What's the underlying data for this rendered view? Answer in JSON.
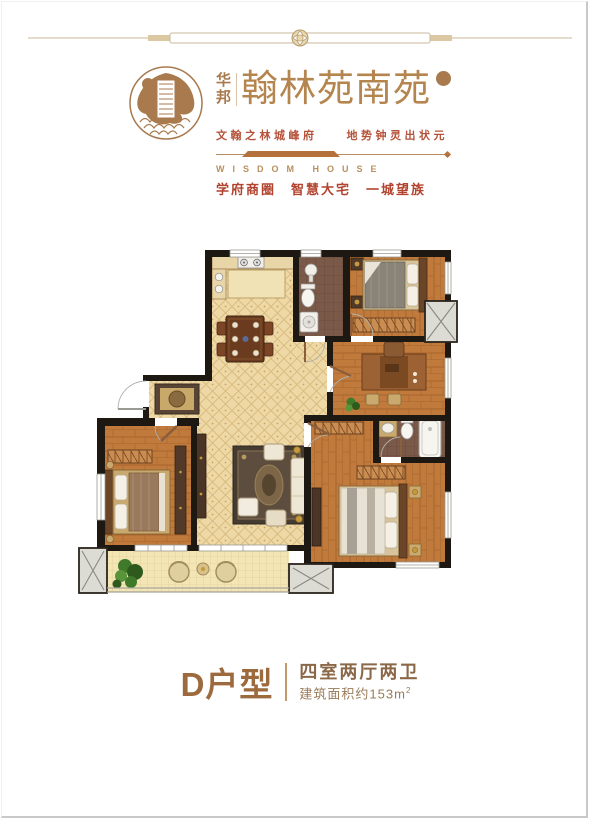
{
  "header": {
    "company": "华邦",
    "company_chars": [
      "华",
      "邦"
    ],
    "project_name": "翰林苑南苑",
    "seal_icon": "round-brand-seal",
    "ornament_icon": "flower-medallion-divider",
    "slogan_primary": "文翰之林城峰府　　地势钟灵出状元",
    "slogan_en": "WISDOM HOUSE",
    "slogan_secondary": "学府商圈　智慧大宅　一城望族"
  },
  "floor_plan": {
    "type": "apartment-floor-plan",
    "rooms": [
      "kitchen",
      "dining-area",
      "bathroom",
      "bedroom-2",
      "study",
      "hallway",
      "entry",
      "living-room",
      "bedroom-1",
      "master-bathroom",
      "master-bedroom",
      "balcony",
      "elevator-shafts"
    ],
    "labels_visible": false
  },
  "footer": {
    "unit_label": "D户型",
    "layout_label": "四室两厅两卫",
    "area_label": "建筑面积约153m",
    "area_superscript": "2"
  },
  "colors": {
    "brand_brown": "#ad7e4e",
    "accent_red": "#b2432e",
    "wall": "#1d1812",
    "tile_floor": "#eed9a6",
    "wood_floor": "#c07a3c",
    "bath_floor": "#7a5949",
    "balcony_floor": "#f3e5b4",
    "shaft_gray": "#dcdcd5"
  }
}
